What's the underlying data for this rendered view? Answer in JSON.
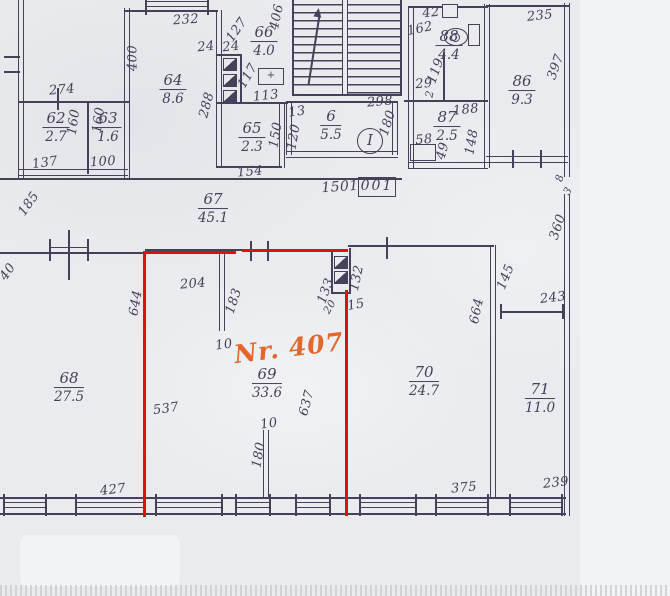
{
  "plan": {
    "flat_label": "Nr. 407",
    "stamp_value": "001",
    "corridor_length": "1501",
    "stair_mark": "I",
    "fixture_mark": "+",
    "rooms": {
      "r62": {
        "no": "62",
        "area": "2.7"
      },
      "r63": {
        "no": "63",
        "area": "1.6"
      },
      "r64": {
        "no": "64",
        "area": "8.6"
      },
      "r65": {
        "no": "65",
        "area": "2.3"
      },
      "r66": {
        "no": "66",
        "area": "4.0"
      },
      "r6": {
        "no": "6",
        "area": "5.5"
      },
      "r88": {
        "no": "88",
        "area": "4.4"
      },
      "r87": {
        "no": "87",
        "area": "2.5"
      },
      "r86": {
        "no": "86",
        "area": "9.3"
      },
      "r67": {
        "no": "67",
        "area": "45.1"
      },
      "r68": {
        "no": "68",
        "area": "27.5"
      },
      "r69": {
        "no": "69",
        "area": "33.6"
      },
      "r70": {
        "no": "70",
        "area": "24.7"
      },
      "r71": {
        "no": "71",
        "area": "11.0"
      }
    },
    "dims": {
      "d232": "232",
      "d400": "400",
      "d127": "127",
      "d24a": "24",
      "d24b": "24",
      "d406": "406",
      "d288": "288",
      "d117": "117",
      "d113": "113",
      "d154": "154",
      "d150": "150",
      "d100": "100",
      "d137": "137",
      "d160a": "160",
      "d160b": "160",
      "d274": "274",
      "d298": "298",
      "d13": "13",
      "d120": "120",
      "d180a": "180",
      "d42": "42",
      "d162": "162",
      "d119": "119",
      "d29": "29",
      "d21": "2",
      "d188": "188",
      "d58": "58",
      "d49": "49",
      "d148": "148",
      "d235": "235",
      "d397": "397",
      "d8": "8",
      "d3": "3",
      "d360": "360",
      "d185": "185",
      "d40": "40",
      "d644": "644",
      "d204": "204",
      "d183": "183",
      "d10a": "10",
      "d133": "133",
      "d132": "132",
      "d20": "20",
      "d15": "15",
      "d537": "537",
      "d637": "637",
      "d10b": "10",
      "d180b": "180",
      "d427": "427",
      "d145": "145",
      "d664": "664",
      "d243": "243",
      "d375": "375",
      "d239": "239"
    }
  },
  "colors": {
    "ink": "#46405a",
    "red": "#e0100f",
    "orange": "#e2672c",
    "paper": "#e9ebee"
  }
}
